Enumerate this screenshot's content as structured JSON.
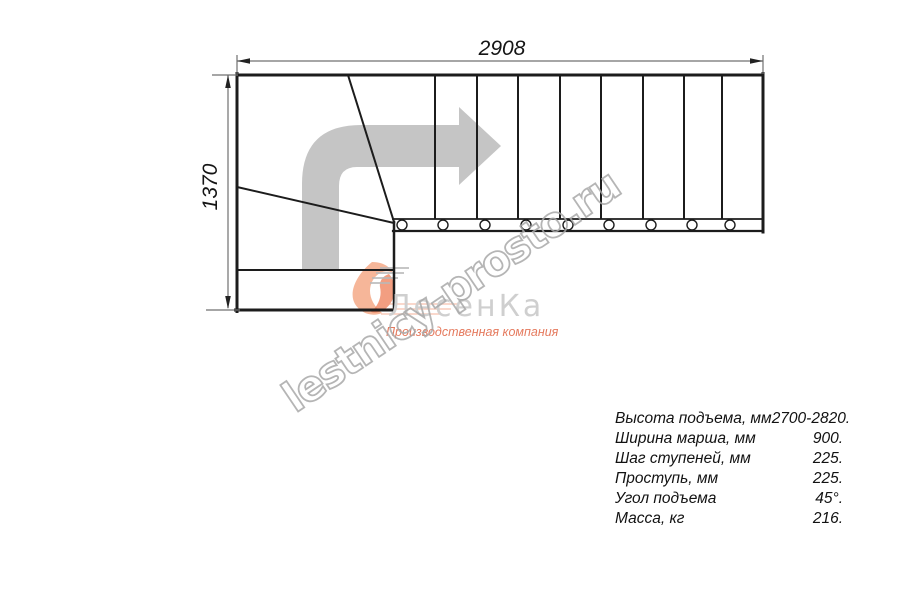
{
  "watermark": {
    "text": "lestnicy-prosto.ru"
  },
  "logo": {
    "company_name": "ЛесенКа",
    "tagline": "Производственная компания"
  },
  "drawing": {
    "width_dimension_mm": "2908",
    "height_dimension_mm": "1370",
    "tread_count_in_run": 9,
    "bolt_circle_count": 9,
    "winder_tread_count": 3
  },
  "specs": {
    "rows": [
      {
        "label": "Высота подъема, мм",
        "value": "2700-2820."
      },
      {
        "label": "Ширина марша, мм",
        "value": "900."
      },
      {
        "label": "Шаг ступеней, мм",
        "value": "225."
      },
      {
        "label": "Проступь, мм",
        "value": "225."
      },
      {
        "label": "Угол подъема",
        "value": "45°."
      },
      {
        "label": "Масса, кг",
        "value": "216."
      }
    ]
  },
  "colors": {
    "outline": "#1c1c1c",
    "dimension": "#707070",
    "dimension_text": "#151515",
    "direction_arrow": "#c5c5c5",
    "watermark": "#a9a9a9",
    "logo_name": "#cfcfcf",
    "logo_accent": "#ed7e57",
    "background": "#ffffff"
  }
}
